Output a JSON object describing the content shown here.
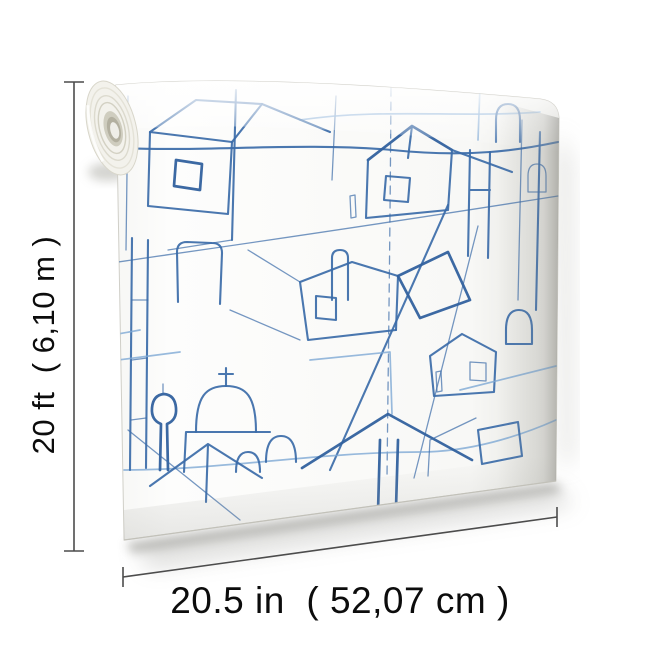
{
  "figure": {
    "height_label": "20 ft  ( 6,10 m )",
    "width_label": "20.5 in  ( 52,07 cm )"
  },
  "colors": {
    "pattern_blue": "#3b6ba8",
    "pattern_blue_light": "#7ea9d4",
    "dimension_line": "#4c4c4c",
    "label_text": "#0c0c0c",
    "background": "#ffffff"
  }
}
